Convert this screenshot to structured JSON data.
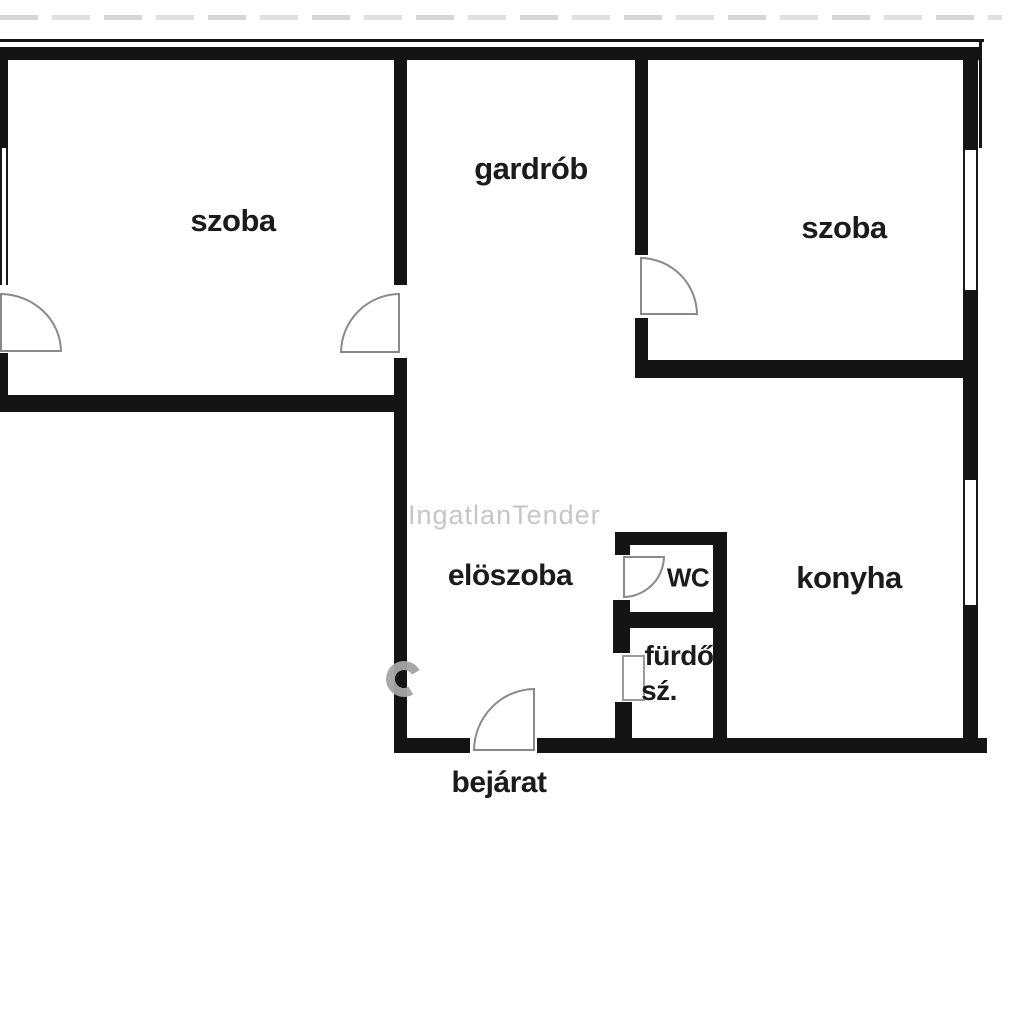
{
  "plan": {
    "type": "apartment-floor-plan",
    "language": "Hungarian",
    "wall_color": "#141414",
    "background_color": "#ffffff",
    "door_outline_color": "#8a8a8a",
    "label_color": "#1b1b1b"
  },
  "rooms": {
    "szoba_left": {
      "label": "szoba"
    },
    "gardrob": {
      "label": "gardrób"
    },
    "szoba_right": {
      "label": "szoba"
    },
    "eloszoba": {
      "label": "elöszoba"
    },
    "wc": {
      "label": "WC"
    },
    "konyha": {
      "label": "konyha"
    },
    "furdo": {
      "label": "fürdő"
    },
    "furdo_sz": {
      "label": "sź."
    },
    "bejarat": {
      "label": "bejárat"
    }
  },
  "watermark": {
    "text": "IngatlanTender",
    "color": "#c6c6c6"
  }
}
